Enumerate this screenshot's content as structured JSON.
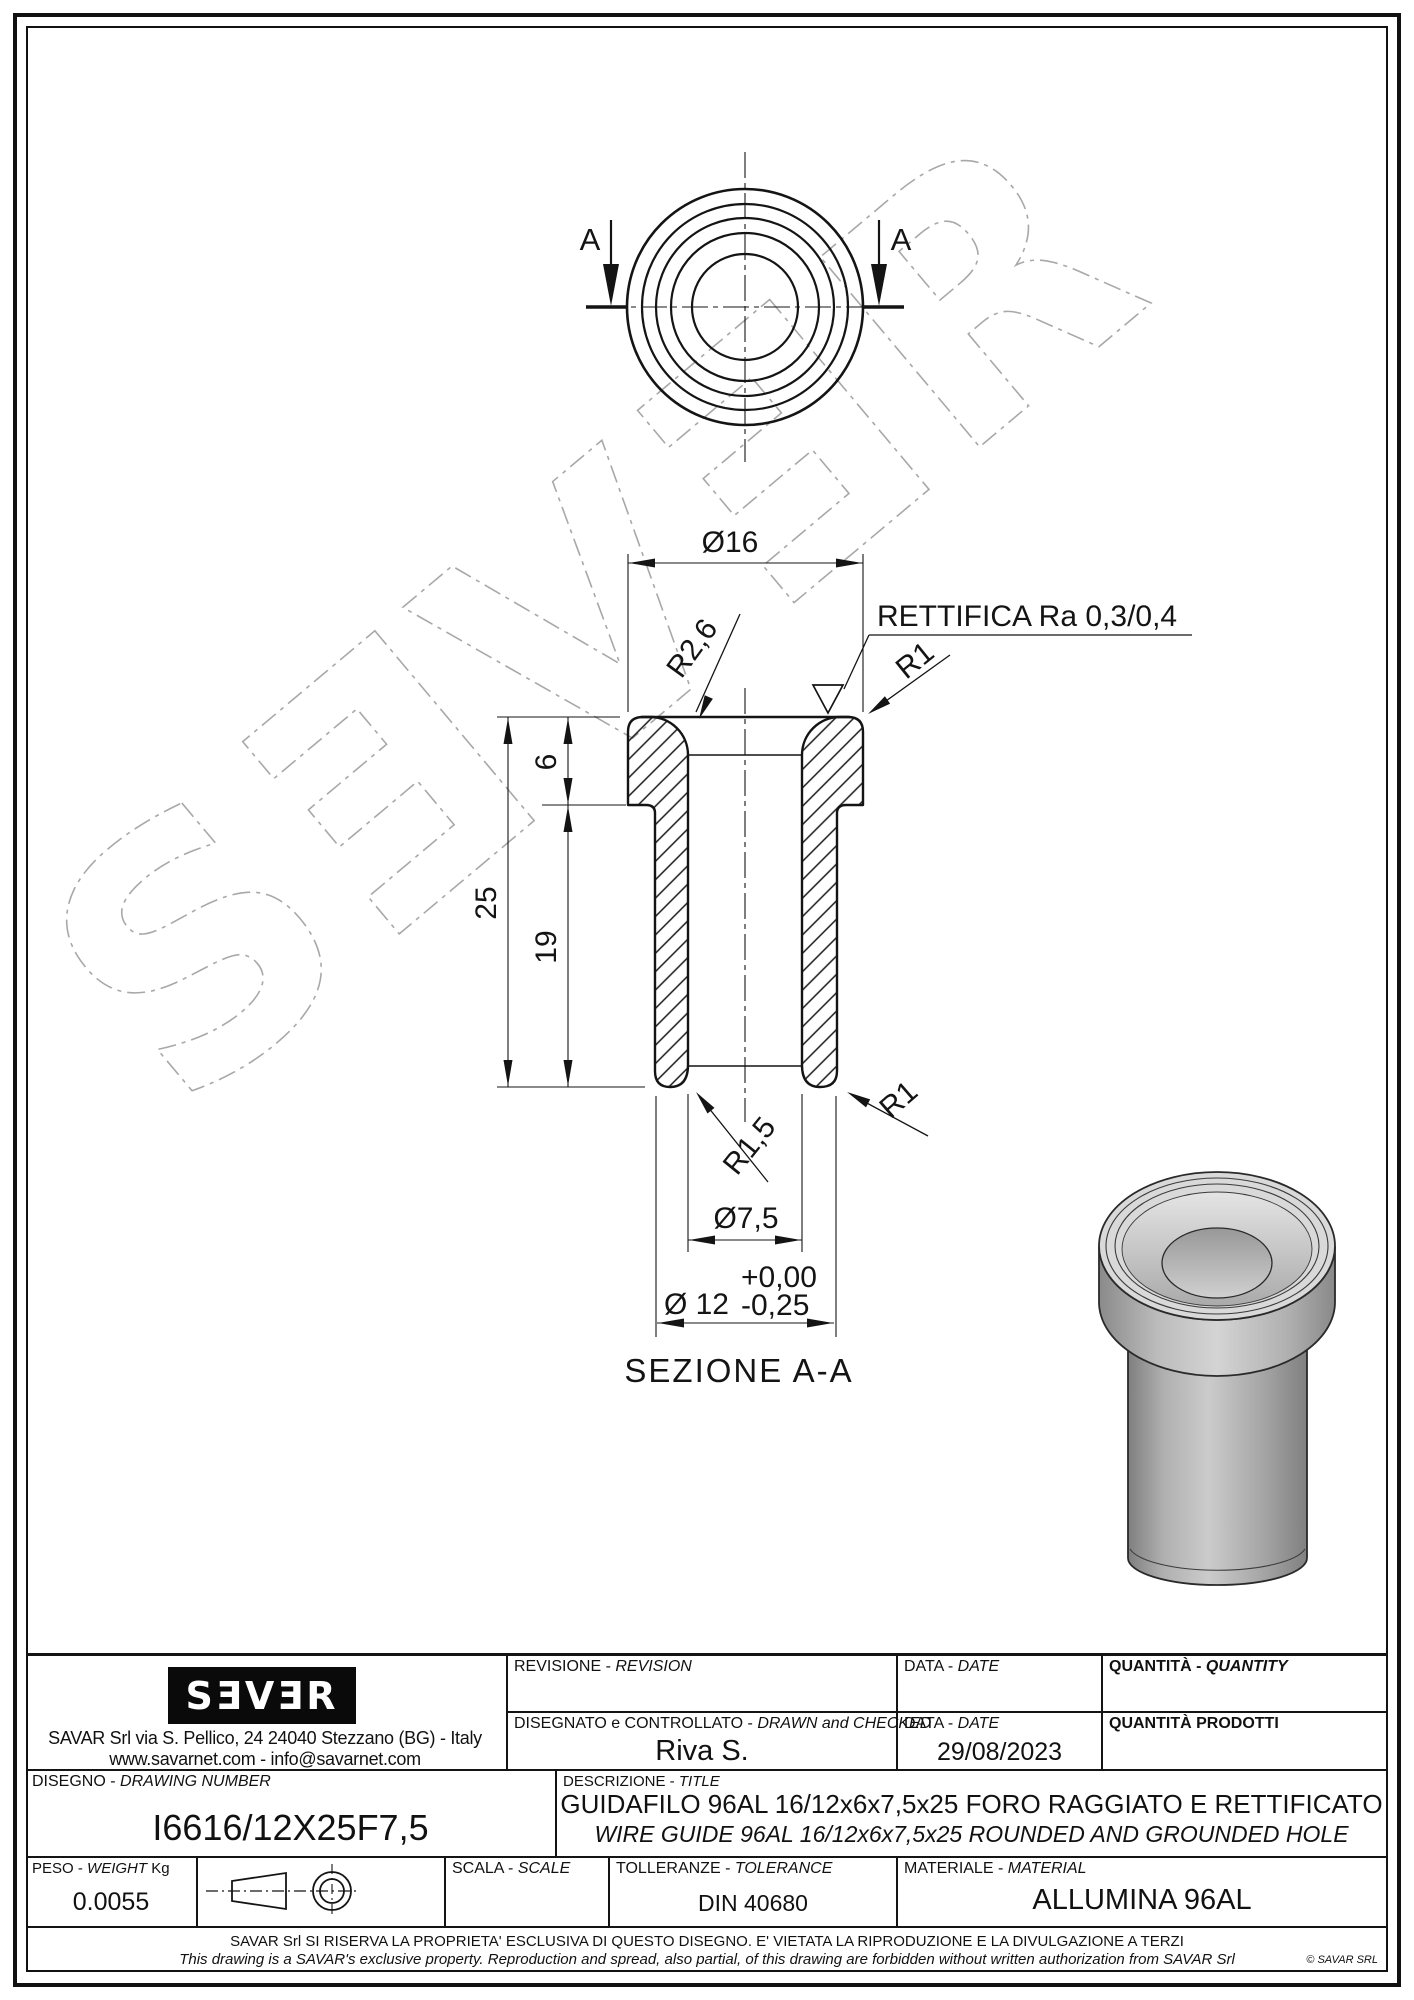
{
  "page": {
    "watermark_text": "SƎVƎR"
  },
  "top_view": {
    "cut_label_left": "A",
    "cut_label_right": "A"
  },
  "section_view": {
    "dim_diameter_16": "Ø16",
    "radius_r26": "R2,6",
    "surface_note": "RETTIFICA Ra 0,3/0,4",
    "radius_r1_top": "R1",
    "dim_6": "6",
    "dim_25": "25",
    "dim_19": "19",
    "radius_r15": "R1,5",
    "radius_r1_bottom": "R1",
    "dim_diameter_75": "Ø7,5",
    "dim_diameter_12": "Ø 12",
    "tolerance_plus": "+0,00",
    "tolerance_minus": "-0,25",
    "caption": "SEZIONE A-A"
  },
  "title_block": {
    "logo_text": "SƎVƎR",
    "address_line1": "SAVAR Srl via S. Pellico, 24  24040 Stezzano (BG) - Italy",
    "address_line2": "www.savarnet.com  -  info@savarnet.com",
    "revision": {
      "label_it": "REVISIONE -",
      "label_en": "REVISION"
    },
    "date_top": {
      "label_it": "DATA -",
      "label_en": "DATE"
    },
    "quantity": {
      "label_it": "QUANTITÀ -",
      "label_en": "QUANTITY"
    },
    "drawn": {
      "label_it": "DISEGNATO e CONTROLLATO -",
      "label_en": "DRAWN and CHECKED",
      "value": "Riva S."
    },
    "date_bottom": {
      "label_it": "DATA -",
      "label_en": "DATE",
      "value": "29/08/2023"
    },
    "quantity_produced": {
      "label": "QUANTITÀ  PRODOTTI"
    },
    "drawing_number": {
      "label_it": "DISEGNO -",
      "label_en": "DRAWING NUMBER",
      "value": "I6616/12X25F7,5"
    },
    "description": {
      "label_it": "DESCRIZIONE -",
      "label_en": "TITLE",
      "value_it": "GUIDAFILO 96AL 16/12x6x7,5x25 FORO RAGGIATO E RETTIFICATO",
      "value_en": "WIRE GUIDE 96AL 16/12x6x7,5x25 ROUNDED AND GROUNDED HOLE"
    },
    "weight": {
      "label_it": "PESO -",
      "label_en": "WEIGHT",
      "label_unit": "Kg",
      "value": "0.0055"
    },
    "scale": {
      "label_it": "SCALA -",
      "label_en": "SCALE"
    },
    "tolerance": {
      "label_it": "TOLLERANZE -",
      "label_en": "TOLERANCE",
      "value": "DIN 40680"
    },
    "material": {
      "label_it": "MATERIALE -",
      "label_en": "MATERIAL",
      "value": "ALLUMINA 96AL"
    },
    "disclaimer_it": "SAVAR Srl SI RISERVA LA PROPRIETA' ESCLUSIVA DI QUESTO DISEGNO. E' VIETATA LA RIPRODUZIONE E LA DIVULGAZIONE A TERZI",
    "disclaimer_en": "This drawing is a SAVAR's exclusive property. Reproduction and spread, also partial, of this drawing are forbidden without written authorization from SAVAR Srl",
    "copyright": "© SAVAR SRL"
  },
  "colors": {
    "line": "#141414",
    "watermark": "#a8a8a8",
    "paper": "#ffffff",
    "render_light": "#d9d9d9",
    "render_mid": "#b5b5b5",
    "render_dark": "#838383"
  }
}
